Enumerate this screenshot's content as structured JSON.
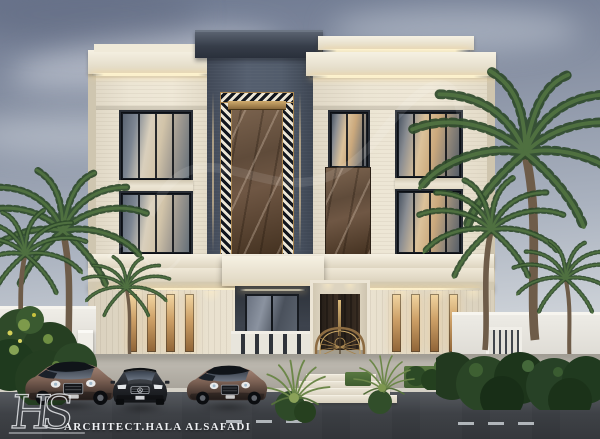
{
  "watermark": {
    "logo_initials": "HS",
    "credit": "ARCHITECT.HALA ALSAFADI"
  },
  "palette": {
    "sky_top": "#6d7890",
    "sky_horizon": "#e4e6e8",
    "stone_cream": "#eae3d3",
    "stone_shadow": "#d8d0bd",
    "tower_slate": "#4e5766",
    "cornice_dark": "#343b47",
    "marble_brown": "#6e5847",
    "bronze_accent": "#c9a767",
    "window_frame": "#272c34",
    "window_amber": "#caa87c",
    "led_warm": "#fff3ce",
    "palm_green": "#3e5c34",
    "hedge_green": "#22391f",
    "asphalt": "#3c3f44",
    "sidewalk": "#b5b1a8",
    "car_bronze": "#7c6154",
    "car_graphite": "#23262b",
    "boundary_wall": "#e9e7e1"
  },
  "scene_elements": [
    "dusk-sky",
    "modern-classic-villa-facade",
    "central-marble-feature-tower",
    "ornate-entrance-gate",
    "palm-trees",
    "luxury-cars",
    "asphalt-road",
    "architect-watermark"
  ]
}
